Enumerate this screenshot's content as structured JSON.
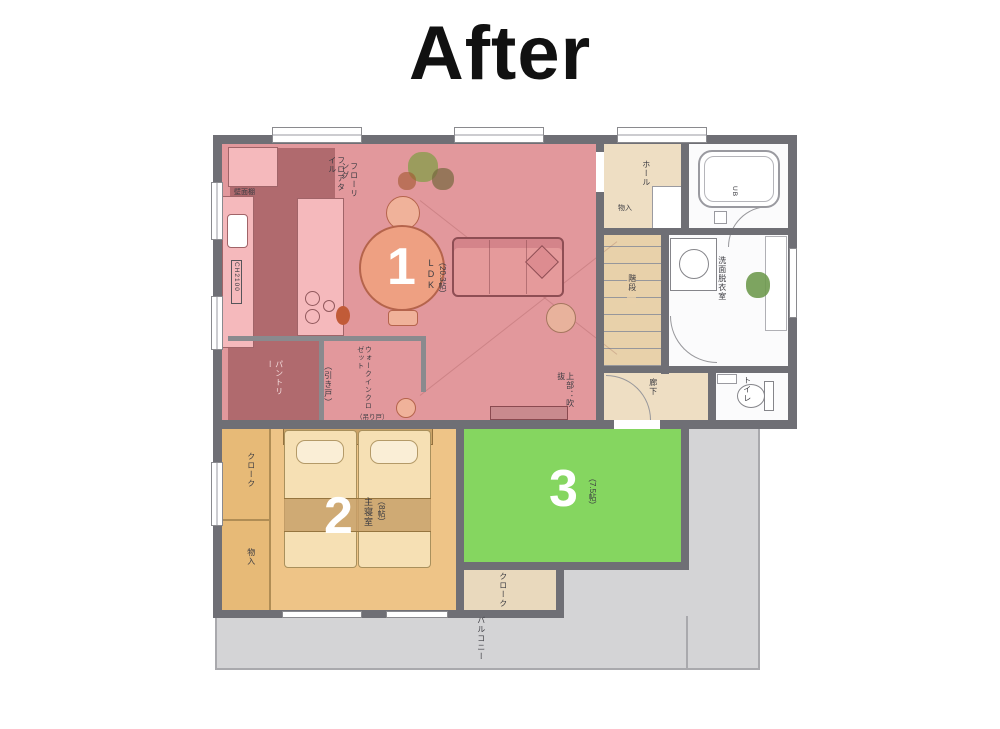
{
  "title": "After",
  "zones": {
    "z1": {
      "number": "1",
      "name": "LDK",
      "size": "（20.3帖）",
      "color": "#e2989c"
    },
    "z2": {
      "number": "2",
      "name": "主寝室",
      "size": "（8帖）",
      "color": "#eec487"
    },
    "z3": {
      "number": "3",
      "name": "",
      "size": "（7.5帖）",
      "color": "#85d660"
    }
  },
  "rooms": {
    "hall": "ホール",
    "storage_hall": "物入",
    "bath_ub": "UB",
    "washroom": "洗面脱衣室",
    "stairs": "階段",
    "corridor": "廊下",
    "toilet": "トイレ",
    "pantry": "パントリー",
    "walk_in_closet": "ウォークインクロゼット",
    "cloak_left": "クローク",
    "storage_left": "物入",
    "cloak_south": "クローク",
    "balcony": "バルコニー"
  },
  "annotations": {
    "wall_shelf": "壁面棚",
    "floor_tile": "フロアタイル",
    "flooring": "フローリング",
    "ceiling_height": "CH2100",
    "sliding_door": "（引き戸）",
    "hanging_door": "（吊り戸）",
    "open_above": "上部：吹抜"
  }
}
